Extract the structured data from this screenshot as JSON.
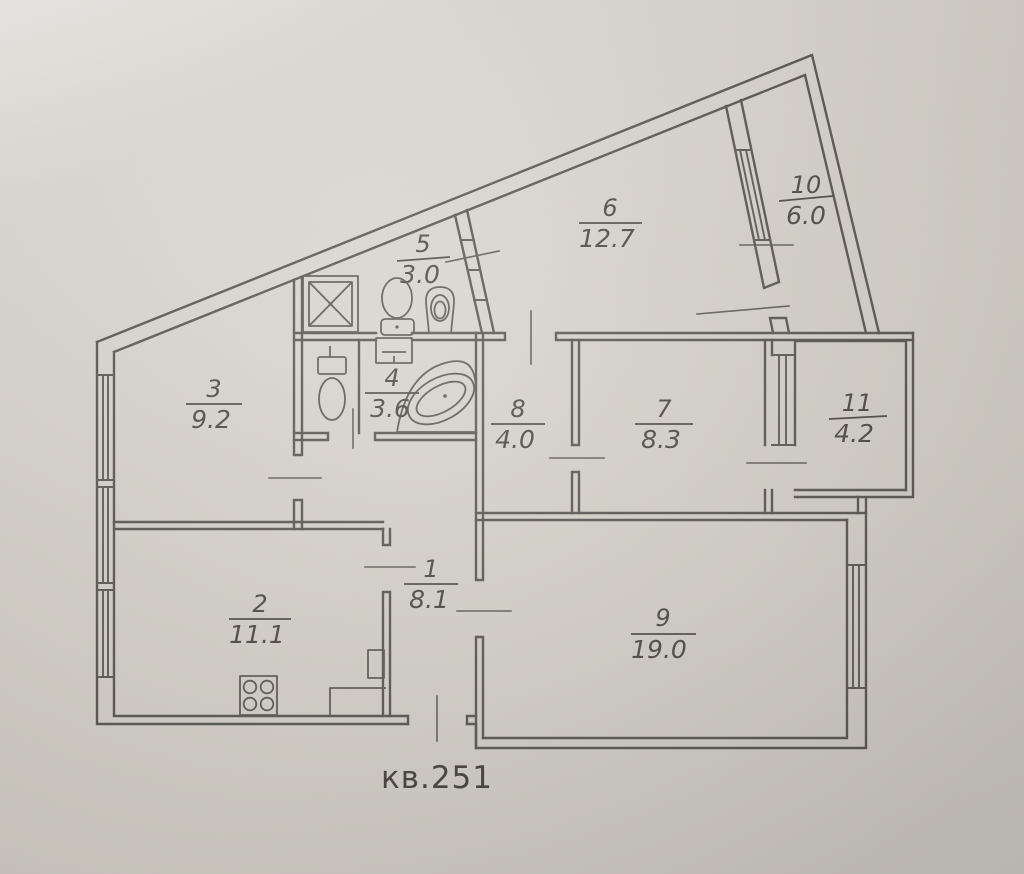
{
  "title": "кв.251",
  "rooms": [
    {
      "num": "1",
      "area": "8.1"
    },
    {
      "num": "2",
      "area": "11.1"
    },
    {
      "num": "3",
      "area": "9.2"
    },
    {
      "num": "4",
      "area": "3.6"
    },
    {
      "num": "5",
      "area": "3.0"
    },
    {
      "num": "6",
      "area": "12.7"
    },
    {
      "num": "7",
      "area": "8.3"
    },
    {
      "num": "8",
      "area": "4.0"
    },
    {
      "num": "9",
      "area": "19.0"
    },
    {
      "num": "10",
      "area": "6.0"
    },
    {
      "num": "11",
      "area": "4.2"
    }
  ],
  "fixtures": [
    "shower-tray",
    "toilet",
    "pedestal-sink",
    "washbasin",
    "corner-bathtub",
    "toilet",
    "stove-4-burner"
  ],
  "colors": {
    "paper": "#d6d2ca",
    "ink": "#57544e",
    "text": "#4a4742"
  }
}
